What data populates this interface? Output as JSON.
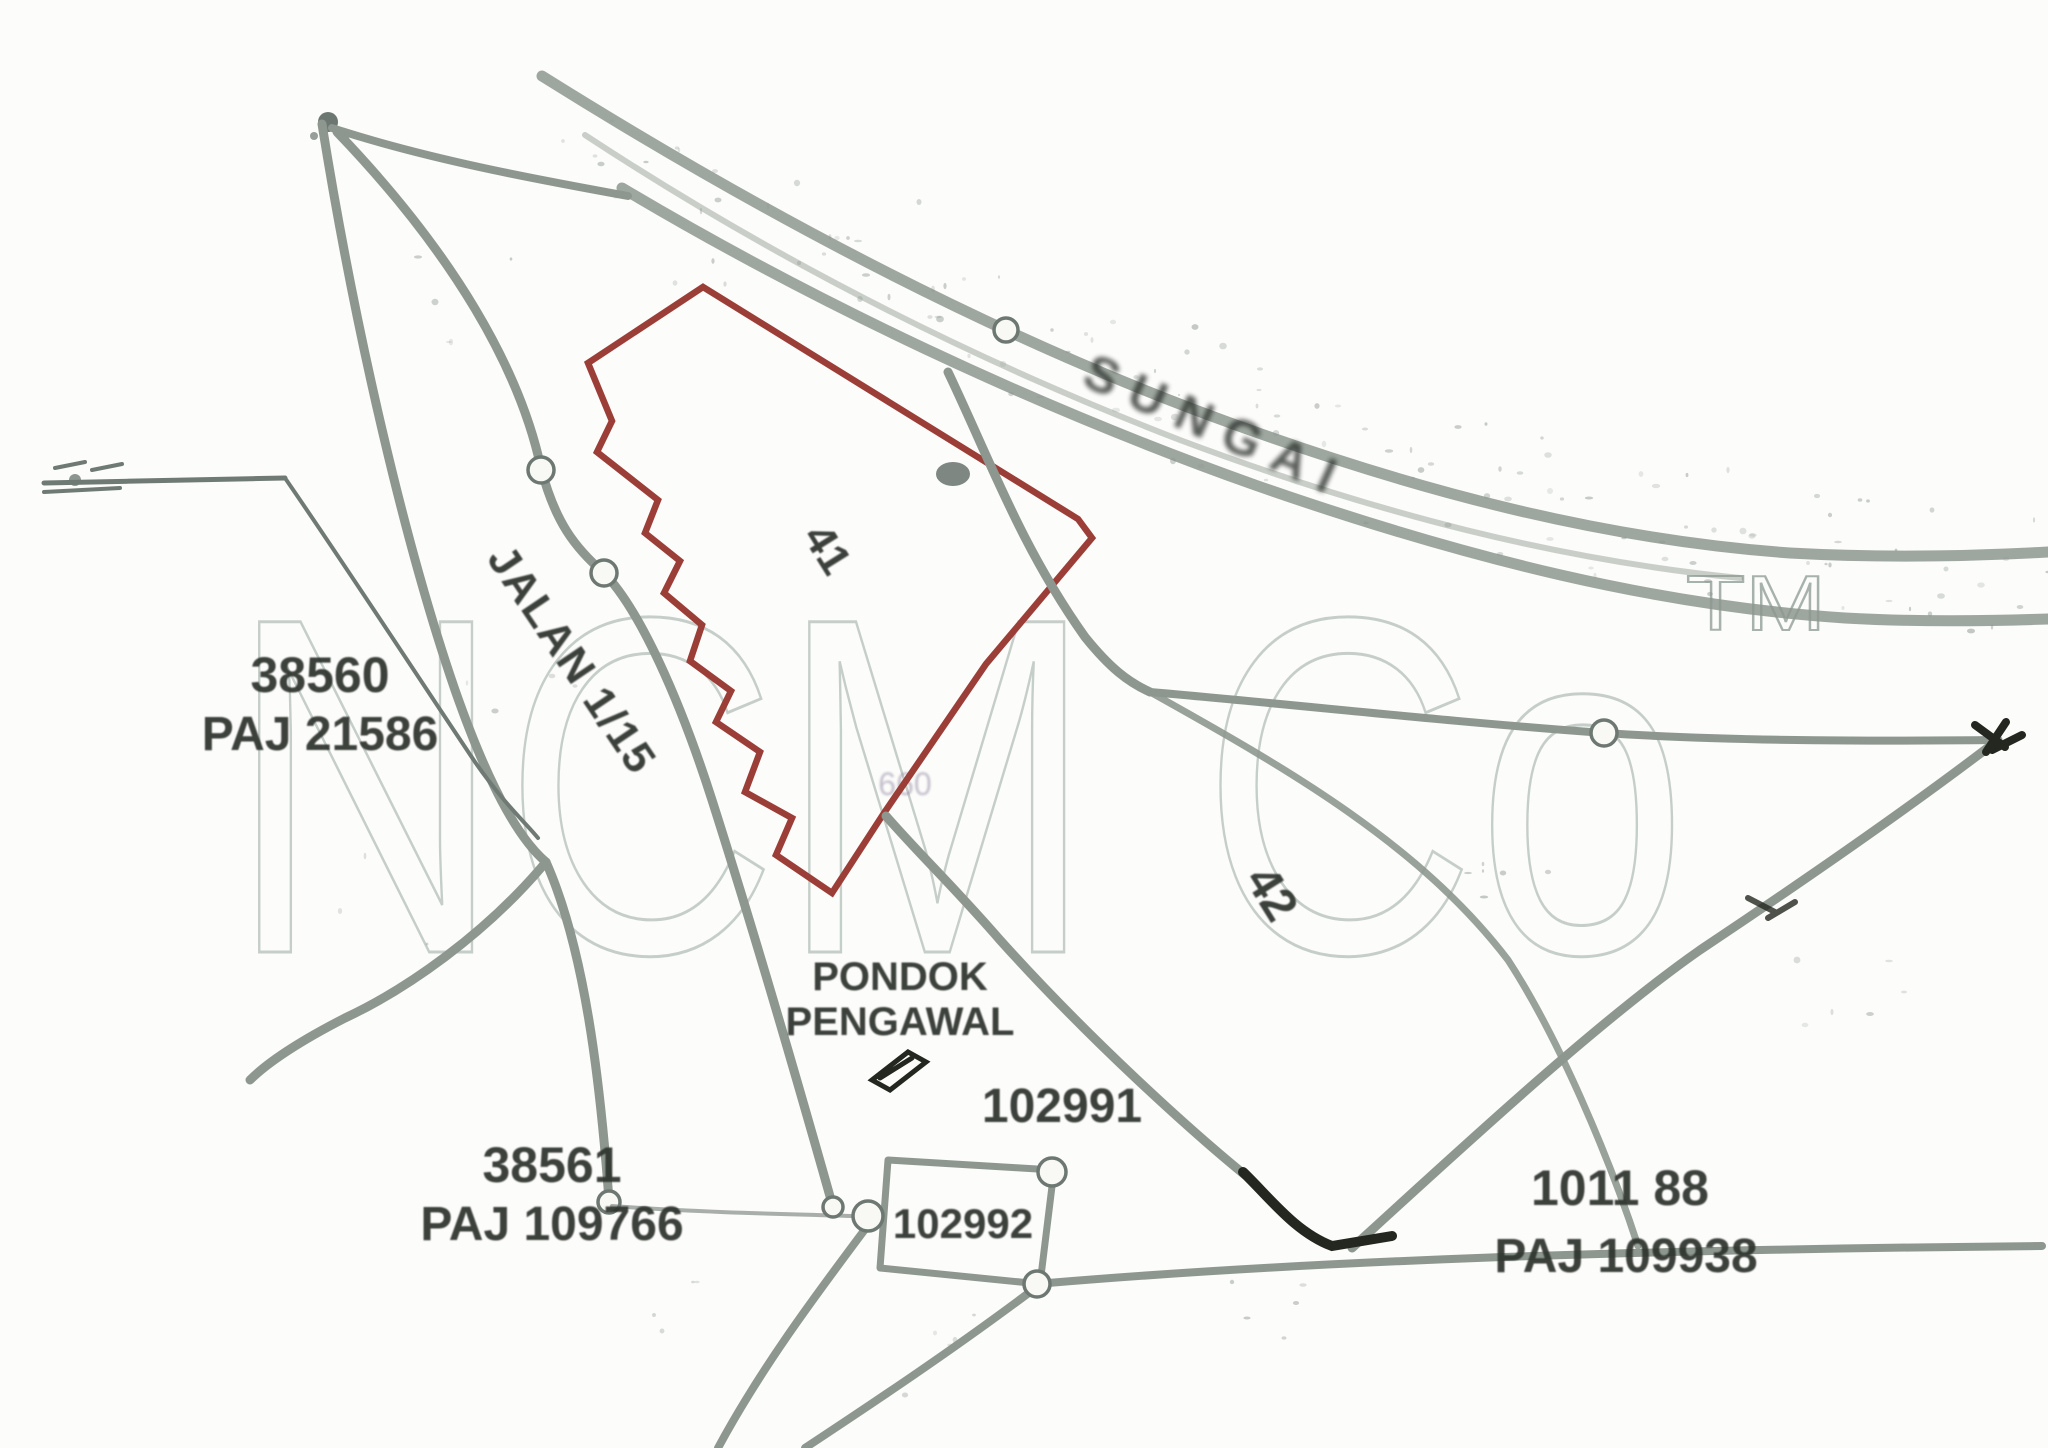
{
  "map": {
    "watermark": {
      "brand": "NCM Co",
      "tm": "TM",
      "fragment": "660"
    },
    "river_label": "SUNGAI",
    "road_label": "JALAN 1/15",
    "guard_house": {
      "line1": "PONDOK",
      "line2": "PENGAWAL"
    },
    "lots": [
      {
        "number": "38560",
        "grant": "PAJ 21586"
      },
      {
        "number": "38561",
        "grant": "PAJ 109766"
      },
      {
        "number": "1011 88",
        "grant": "PAJ 109938"
      }
    ],
    "parcels": {
      "p1": "102991",
      "p2": "102992"
    },
    "plot_marks": {
      "m1": "41",
      "m2": "42"
    },
    "colors": {
      "parcel_outline": "#9c3e38",
      "boundary_gray": "#8d978f",
      "label_dark": "#2e332e",
      "watermark_gray": "#c6cec9"
    }
  }
}
